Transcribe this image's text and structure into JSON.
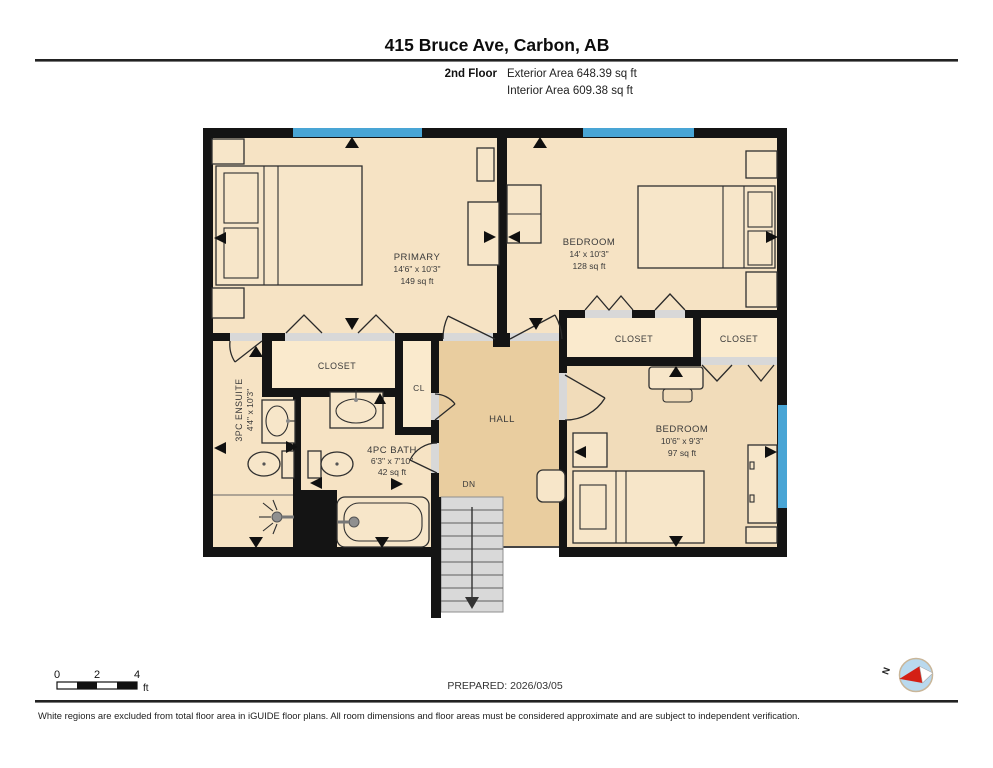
{
  "header": {
    "title": "415 Bruce Ave, Carbon, AB",
    "floor_label": "2nd Floor",
    "exterior_area": "Exterior Area 648.39 sq ft",
    "interior_area": "Interior Area 609.38 sq ft"
  },
  "rooms": {
    "primary": {
      "name": "PRIMARY",
      "dims": "14'6\" x 10'3\"",
      "area": "149 sq ft"
    },
    "bedroom2": {
      "name": "BEDROOM",
      "dims": "14' x 10'3\"",
      "area": "128 sq ft"
    },
    "bedroom3": {
      "name": "BEDROOM",
      "dims": "10'6\" x 9'3\"",
      "area": "97 sq ft"
    },
    "bath": {
      "name": "4PC BATH",
      "dims": "6'3\" x 7'10\"",
      "area": "42 sq ft"
    },
    "ensuite": {
      "name": "3PC ENSUITE",
      "dims": "4'4\" x 10'3\""
    },
    "closet_primary": {
      "name": "CLOSET"
    },
    "closet_left": {
      "name": "CLOSET"
    },
    "closet_right": {
      "name": "CLOSET"
    },
    "cl": {
      "name": "CL"
    },
    "hall": {
      "name": "HALL"
    },
    "stairs": {
      "label": "DN"
    }
  },
  "footer": {
    "scale": {
      "t0": "0",
      "t2": "2",
      "t4": "4",
      "unit": "ft"
    },
    "prepared": "PREPARED: 2026/03/05",
    "compass": {
      "north": "N"
    },
    "disclaimer": "White regions are excluded from total floor area in iGUIDE floor plans. All room dimensions and floor areas must be considered approximate and are subject to independent verification."
  },
  "colors": {
    "wall": "#141414",
    "room_floor": "#f6e3c4",
    "closet_floor": "#faeacd",
    "hall_floor": "#e9cd9f",
    "bedroom3_floor": "#f1dcba",
    "window_blue": "#49a5d5",
    "door_sill_gray": "#d8d8d8",
    "stair_gray": "#d9d9d9",
    "compass_blue": "#b9d9ee",
    "compass_needle_red": "#d42015"
  }
}
